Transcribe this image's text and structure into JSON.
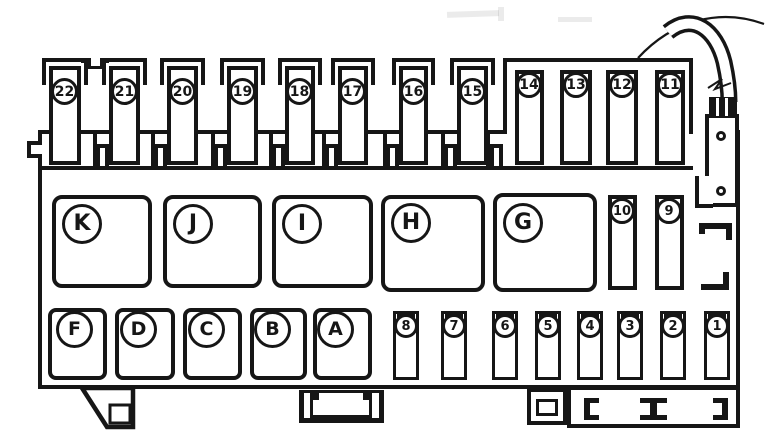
{
  "diagram": {
    "type": "fuse-box-layout",
    "line_color": "#161616",
    "background_color": "#ffffff"
  },
  "fuses": {
    "top_row": [
      "22",
      "21",
      "20",
      "19",
      "18",
      "17",
      "16",
      "15"
    ],
    "header_block": [
      "14",
      "13",
      "12",
      "11"
    ],
    "side_column": [
      "10",
      "9"
    ],
    "bottom_row": [
      "8",
      "7",
      "6",
      "5",
      "4",
      "3",
      "2",
      "1"
    ]
  },
  "relays": {
    "large_row": [
      "K",
      "J",
      "I",
      "H",
      "G"
    ],
    "small_row": [
      "F",
      "D",
      "C",
      "B",
      "A"
    ]
  }
}
